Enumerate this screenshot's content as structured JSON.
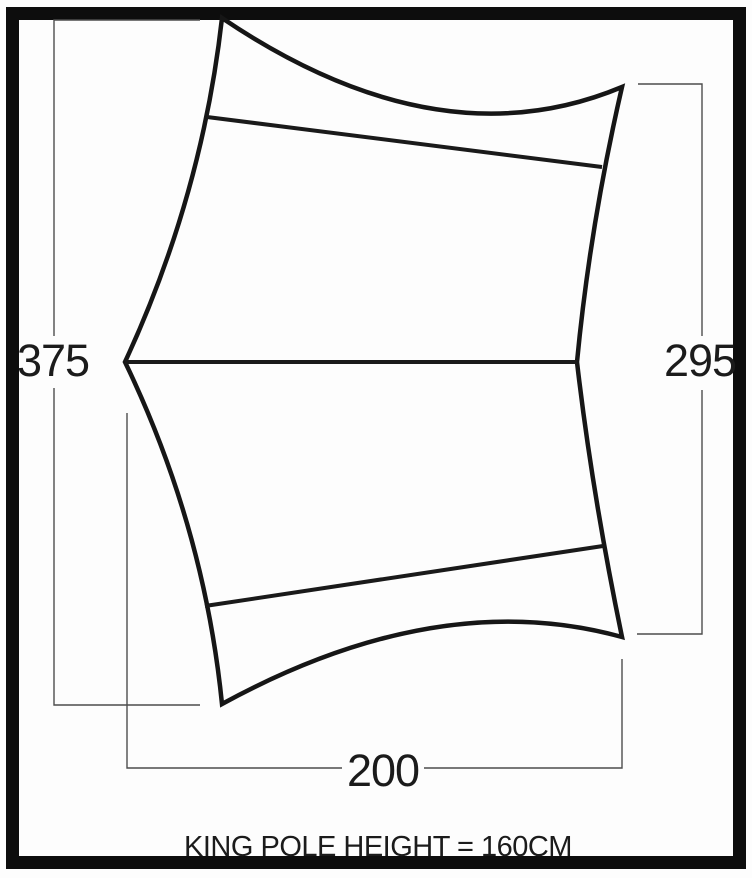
{
  "diagram": {
    "kind": "tarp-plan-dimension-diagram",
    "dimensions": {
      "left": "375",
      "right": "295",
      "bottom": "200"
    },
    "caption": "KING POLE HEIGHT = 160CM",
    "colors": {
      "background": "#fdfdfd",
      "frame": "#0d0d0d",
      "outline": "#161616",
      "seam": "#1a1a1a",
      "dimension_line": "#4d4d4d",
      "text": "#1b1b1b"
    }
  }
}
